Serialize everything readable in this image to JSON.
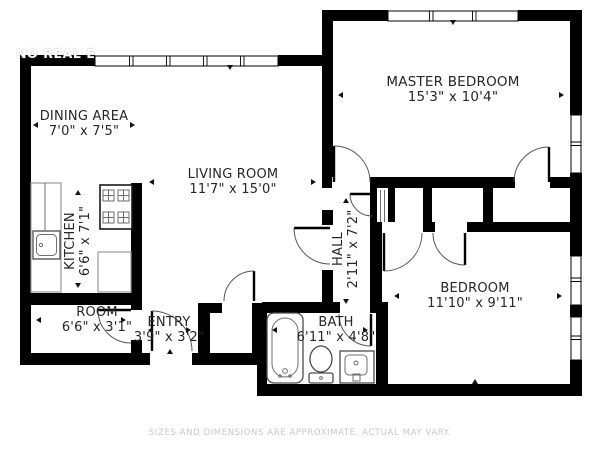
{
  "watermark": "NO REAL E",
  "disclaimer": "SIZES AND DIMENSIONS ARE APPROXIMATE, ACTUAL MAY VARY.",
  "colors": {
    "wall": "#000000",
    "background": "#ffffff",
    "label_text": "#262626",
    "disclaimer_text": "#c7c7c7",
    "watermark_text": "#ffffff",
    "fixture_stroke": "#4a4a4a"
  },
  "rooms": [
    {
      "id": "dining-area",
      "name": "DINING AREA",
      "dims": "7'0\" x 7'5\""
    },
    {
      "id": "living-room",
      "name": "LIVING ROOM",
      "dims": "11'7\" x 15'0\""
    },
    {
      "id": "master-bedroom",
      "name": "MASTER BEDROOM",
      "dims": "15'3\" x 10'4\""
    },
    {
      "id": "kitchen",
      "name": "KITCHEN",
      "dims": "6'6\" x 7'1\""
    },
    {
      "id": "hall",
      "name": "HALL",
      "dims": "2'11\" x 7'2\""
    },
    {
      "id": "room",
      "name": "ROOM",
      "dims": "6'6\" x 3'1\""
    },
    {
      "id": "entry",
      "name": "ENTRY",
      "dims": "3'9\" x 3'2\""
    },
    {
      "id": "bath",
      "name": "BATH",
      "dims": "6'11\" x 4'8\""
    },
    {
      "id": "bedroom",
      "name": "BEDROOM",
      "dims": "11'10\" x 9'11\""
    }
  ],
  "fixtures": [
    "stove-icon",
    "kitchen-counter",
    "kitchen-sink-icon",
    "bathtub-icon",
    "toilet-icon",
    "vanity-sink-icon",
    "closet-shelves"
  ]
}
